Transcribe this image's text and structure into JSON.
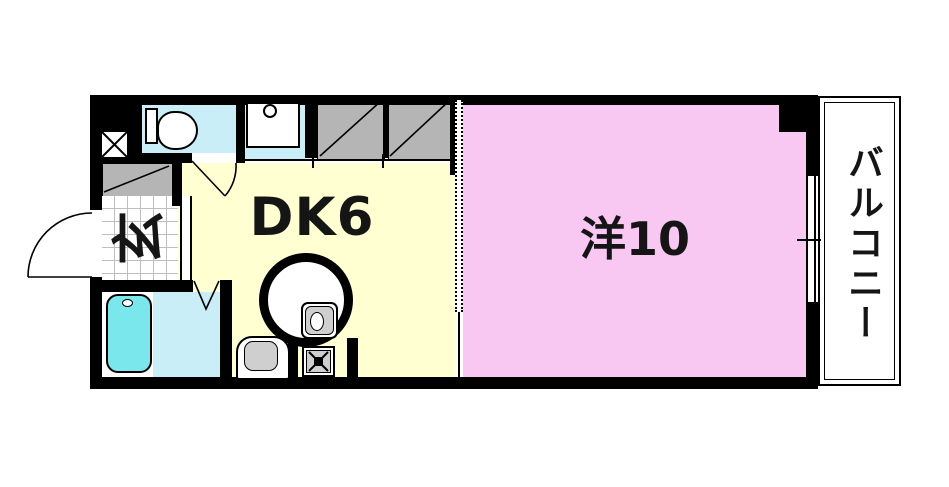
{
  "floorplan": {
    "rooms": {
      "dk": {
        "label": "DK6"
      },
      "western": {
        "label": "洋10"
      },
      "entrance": {
        "label": "玄"
      },
      "balcony": {
        "label": "バルコニー"
      }
    },
    "colors": {
      "wall": "#000000",
      "dk-floor": "#FFFFD2",
      "western-floor": "#F8C8F2",
      "wet-room": "#C9EEF8",
      "bathtub": "#79E7EC",
      "closet": "#B5B5B5",
      "fixture-gray": "#CFCFCF",
      "grid-line": "#BFBFBF"
    }
  }
}
